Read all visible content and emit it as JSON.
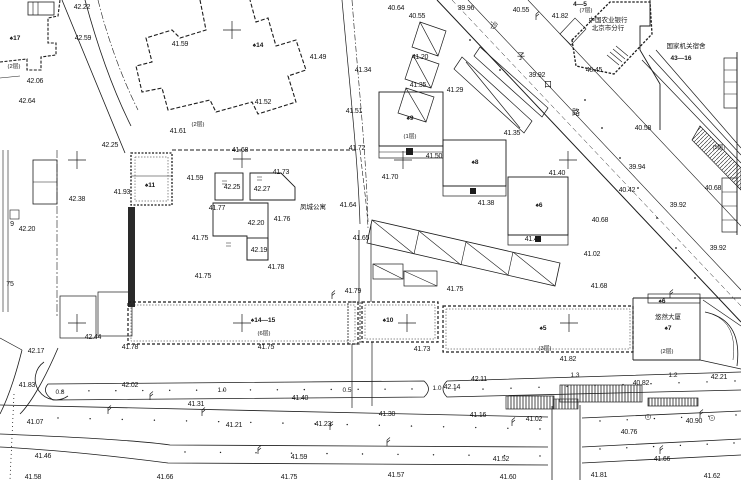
{
  "drawing": {
    "bg_color": "#ffffff",
    "ink_color": "#1c1c1c",
    "street_name_chars": [
      {
        "t": "沙",
        "x": 494,
        "y": 28
      },
      {
        "t": "子",
        "x": 521,
        "y": 59
      },
      {
        "t": "口",
        "x": 548,
        "y": 87
      },
      {
        "t": "路",
        "x": 576,
        "y": 115
      }
    ],
    "place_names": [
      {
        "t": "中国农业银行",
        "x": 608,
        "y": 22
      },
      {
        "t": "北京市分行",
        "x": 608,
        "y": 30
      },
      {
        "t": "国家机关宿舍",
        "x": 686,
        "y": 48
      },
      {
        "t": "凤城公寓",
        "x": 313,
        "y": 209
      },
      {
        "t": "悠然大厦",
        "x": 668,
        "y": 319
      }
    ],
    "building_labels": [
      {
        "t": "♠17",
        "x": 15,
        "y": 40
      },
      {
        "t": "♠14",
        "x": 258,
        "y": 47
      },
      {
        "t": "4—5",
        "x": 580,
        "y": 6
      },
      {
        "t": "43—16",
        "x": 681,
        "y": 60
      },
      {
        "t": "♠11",
        "x": 150,
        "y": 187
      },
      {
        "t": "♠9",
        "x": 410,
        "y": 120
      },
      {
        "t": "♠8",
        "x": 475,
        "y": 164
      },
      {
        "t": "♠6",
        "x": 539,
        "y": 207
      },
      {
        "t": "♠10",
        "x": 388,
        "y": 322
      },
      {
        "t": "♠14—15",
        "x": 263,
        "y": 322
      },
      {
        "t": "♠5",
        "x": 543,
        "y": 330
      },
      {
        "t": "♠7",
        "x": 668,
        "y": 330
      },
      {
        "t": "♠6",
        "x": 662,
        "y": 303
      }
    ],
    "floor_labels": [
      {
        "t": "(2层)",
        "x": 14,
        "y": 68
      },
      {
        "t": "(2层)",
        "x": 198,
        "y": 126
      },
      {
        "t": "(7层)",
        "x": 586,
        "y": 12
      },
      {
        "t": "(1层)",
        "x": 410,
        "y": 138
      },
      {
        "t": "(5层)",
        "x": 719,
        "y": 149
      },
      {
        "t": "(6层)",
        "x": 264,
        "y": 335
      },
      {
        "t": "(3层)",
        "x": 545,
        "y": 350
      },
      {
        "t": "(2层)",
        "x": 667,
        "y": 353
      }
    ],
    "gap_dims": [
      {
        "t": "0.8",
        "x": 60,
        "y": 394
      },
      {
        "t": "1.0",
        "x": 222,
        "y": 392
      },
      {
        "t": "0.5",
        "x": 347,
        "y": 392
      },
      {
        "t": "1.0",
        "x": 437,
        "y": 390
      },
      {
        "t": "1.3",
        "x": 575,
        "y": 377
      },
      {
        "t": "1.2",
        "x": 673,
        "y": 377
      }
    ],
    "misc_texts": [
      {
        "t": "9",
        "x": 12,
        "y": 226
      },
      {
        "t": "75",
        "x": 10,
        "y": 286
      }
    ],
    "elevations": [
      {
        "v": "42.22",
        "x": 82,
        "y": 9
      },
      {
        "v": "42.59",
        "x": 83,
        "y": 40
      },
      {
        "v": "42.06",
        "x": 35,
        "y": 83
      },
      {
        "v": "42.64",
        "x": 27,
        "y": 103
      },
      {
        "v": "41.59",
        "x": 180,
        "y": 46
      },
      {
        "v": "41.61",
        "x": 178,
        "y": 133
      },
      {
        "v": "42.25",
        "x": 110,
        "y": 147
      },
      {
        "v": "41.52",
        "x": 263,
        "y": 104
      },
      {
        "v": "41.49",
        "x": 318,
        "y": 59
      },
      {
        "v": "41.51",
        "x": 354,
        "y": 113
      },
      {
        "v": "40.64",
        "x": 396,
        "y": 10
      },
      {
        "v": "40.55",
        "x": 417,
        "y": 18
      },
      {
        "v": "39.96",
        "x": 466,
        "y": 10
      },
      {
        "v": "40.55",
        "x": 521,
        "y": 12
      },
      {
        "v": "41.82",
        "x": 560,
        "y": 18
      },
      {
        "v": "40.45",
        "x": 594,
        "y": 72
      },
      {
        "v": "39.92",
        "x": 537,
        "y": 77
      },
      {
        "v": "41.20",
        "x": 420,
        "y": 59
      },
      {
        "v": "41.34",
        "x": 363,
        "y": 72
      },
      {
        "v": "41.35",
        "x": 418,
        "y": 87
      },
      {
        "v": "41.29",
        "x": 455,
        "y": 92
      },
      {
        "v": "41.35",
        "x": 512,
        "y": 135
      },
      {
        "v": "41.50",
        "x": 434,
        "y": 158
      },
      {
        "v": "41.72",
        "x": 357,
        "y": 150
      },
      {
        "v": "40.58",
        "x": 643,
        "y": 130
      },
      {
        "v": "39.94",
        "x": 637,
        "y": 169
      },
      {
        "v": "40.42",
        "x": 627,
        "y": 192
      },
      {
        "v": "40.68",
        "x": 713,
        "y": 190
      },
      {
        "v": "39.92",
        "x": 678,
        "y": 207
      },
      {
        "v": "40.68",
        "x": 600,
        "y": 222
      },
      {
        "v": "39.92",
        "x": 718,
        "y": 250
      },
      {
        "v": "42.38",
        "x": 77,
        "y": 201
      },
      {
        "v": "42.20",
        "x": 27,
        "y": 231
      },
      {
        "v": "41.93",
        "x": 122,
        "y": 194
      },
      {
        "v": "41.59",
        "x": 195,
        "y": 180
      },
      {
        "v": "42.25",
        "x": 232,
        "y": 189
      },
      {
        "v": "42.27",
        "x": 262,
        "y": 191
      },
      {
        "v": "41.68",
        "x": 240,
        "y": 152
      },
      {
        "v": "41.73",
        "x": 281,
        "y": 174
      },
      {
        "v": "41.77",
        "x": 217,
        "y": 210
      },
      {
        "v": "42.20",
        "x": 256,
        "y": 225
      },
      {
        "v": "41.76",
        "x": 282,
        "y": 221
      },
      {
        "v": "41.75",
        "x": 200,
        "y": 240
      },
      {
        "v": "42.19",
        "x": 259,
        "y": 252
      },
      {
        "v": "41.78",
        "x": 276,
        "y": 269
      },
      {
        "v": "41.75",
        "x": 203,
        "y": 278
      },
      {
        "v": "41.64",
        "x": 348,
        "y": 207
      },
      {
        "v": "41.65",
        "x": 361,
        "y": 240
      },
      {
        "v": "41.70",
        "x": 390,
        "y": 179
      },
      {
        "v": "41.38",
        "x": 486,
        "y": 205
      },
      {
        "v": "41.40",
        "x": 557,
        "y": 175
      },
      {
        "v": "41.45",
        "x": 533,
        "y": 241
      },
      {
        "v": "41.02",
        "x": 592,
        "y": 256
      },
      {
        "v": "41.68",
        "x": 599,
        "y": 288
      },
      {
        "v": "41.79",
        "x": 353,
        "y": 293
      },
      {
        "v": "41.75",
        "x": 455,
        "y": 291
      },
      {
        "v": "41.75",
        "x": 266,
        "y": 349
      },
      {
        "v": "41.73",
        "x": 422,
        "y": 351
      },
      {
        "v": "41.82",
        "x": 568,
        "y": 361
      },
      {
        "v": "42.44",
        "x": 93,
        "y": 339
      },
      {
        "v": "42.17",
        "x": 36,
        "y": 353
      },
      {
        "v": "41.78",
        "x": 130,
        "y": 349
      },
      {
        "v": "41.83",
        "x": 27,
        "y": 387
      },
      {
        "v": "42.02",
        "x": 130,
        "y": 387
      },
      {
        "v": "41.40",
        "x": 300,
        "y": 400
      },
      {
        "v": "42.14",
        "x": 452,
        "y": 389
      },
      {
        "v": "42.11",
        "x": 479,
        "y": 381
      },
      {
        "v": "40.82",
        "x": 641,
        "y": 385
      },
      {
        "v": "42.21",
        "x": 719,
        "y": 379
      },
      {
        "v": "41.31",
        "x": 196,
        "y": 406
      },
      {
        "v": "41.07",
        "x": 35,
        "y": 424
      },
      {
        "v": "41.21",
        "x": 234,
        "y": 427
      },
      {
        "v": "41.23",
        "x": 323,
        "y": 426
      },
      {
        "v": "41.30",
        "x": 387,
        "y": 416
      },
      {
        "v": "41.16",
        "x": 478,
        "y": 417
      },
      {
        "v": "41.02",
        "x": 534,
        "y": 421
      },
      {
        "v": "40.76",
        "x": 629,
        "y": 434
      },
      {
        "v": "40.90",
        "x": 694,
        "y": 423
      },
      {
        "v": "41.46",
        "x": 43,
        "y": 458
      },
      {
        "v": "41.59",
        "x": 299,
        "y": 459
      },
      {
        "v": "41.52",
        "x": 501,
        "y": 461
      },
      {
        "v": "41.66",
        "x": 662,
        "y": 461
      },
      {
        "v": "41.58",
        "x": 33,
        "y": 479
      },
      {
        "v": "41.66",
        "x": 165,
        "y": 479
      },
      {
        "v": "41.75",
        "x": 289,
        "y": 479
      },
      {
        "v": "41.57",
        "x": 396,
        "y": 477
      },
      {
        "v": "41.60",
        "x": 508,
        "y": 479
      },
      {
        "v": "41.81",
        "x": 599,
        "y": 477
      },
      {
        "v": "41.62",
        "x": 712,
        "y": 478
      }
    ],
    "survey_crosses": [
      {
        "x": 232,
        "y": 30
      },
      {
        "x": 77,
        "y": 160
      },
      {
        "x": 242,
        "y": 159
      },
      {
        "x": 403,
        "y": 160
      },
      {
        "x": 568,
        "y": 160
      },
      {
        "x": 77,
        "y": 323
      },
      {
        "x": 242,
        "y": 323
      },
      {
        "x": 407,
        "y": 323
      },
      {
        "x": 569,
        "y": 323
      }
    ],
    "lamps": [
      {
        "x": 536,
        "y": 14
      },
      {
        "x": 332,
        "y": 293
      },
      {
        "x": 670,
        "y": 292
      },
      {
        "x": 150,
        "y": 394
      },
      {
        "x": 108,
        "y": 408
      },
      {
        "x": 202,
        "y": 410
      },
      {
        "x": 330,
        "y": 424
      },
      {
        "x": 387,
        "y": 440
      },
      {
        "x": 512,
        "y": 420
      },
      {
        "x": 258,
        "y": 448
      },
      {
        "x": 660,
        "y": 448
      },
      {
        "x": 700,
        "y": 412
      }
    ],
    "street_points": [
      {
        "x": 585,
        "y": 100
      },
      {
        "x": 602,
        "y": 128
      },
      {
        "x": 620,
        "y": 158
      },
      {
        "x": 638,
        "y": 188
      },
      {
        "x": 657,
        "y": 218
      },
      {
        "x": 676,
        "y": 248
      },
      {
        "x": 695,
        "y": 278
      },
      {
        "x": 470,
        "y": 40
      },
      {
        "x": 500,
        "y": 70
      }
    ],
    "dot_rows": [
      {
        "x1": 62,
        "y1": 391,
        "x2": 412,
        "y2": 389,
        "n": 14
      },
      {
        "x1": 455,
        "y1": 390,
        "x2": 735,
        "y2": 381,
        "n": 11
      },
      {
        "x1": 58,
        "y1": 418,
        "x2": 540,
        "y2": 429,
        "n": 16
      },
      {
        "x1": 600,
        "y1": 421,
        "x2": 736,
        "y2": 415,
        "n": 6
      },
      {
        "x1": 185,
        "y1": 452,
        "x2": 540,
        "y2": 456,
        "n": 11
      },
      {
        "x1": 600,
        "y1": 449,
        "x2": 734,
        "y2": 443,
        "n": 6
      }
    ],
    "trees": [
      {
        "x": 648,
        "y": 417
      },
      {
        "x": 712,
        "y": 418
      }
    ]
  }
}
